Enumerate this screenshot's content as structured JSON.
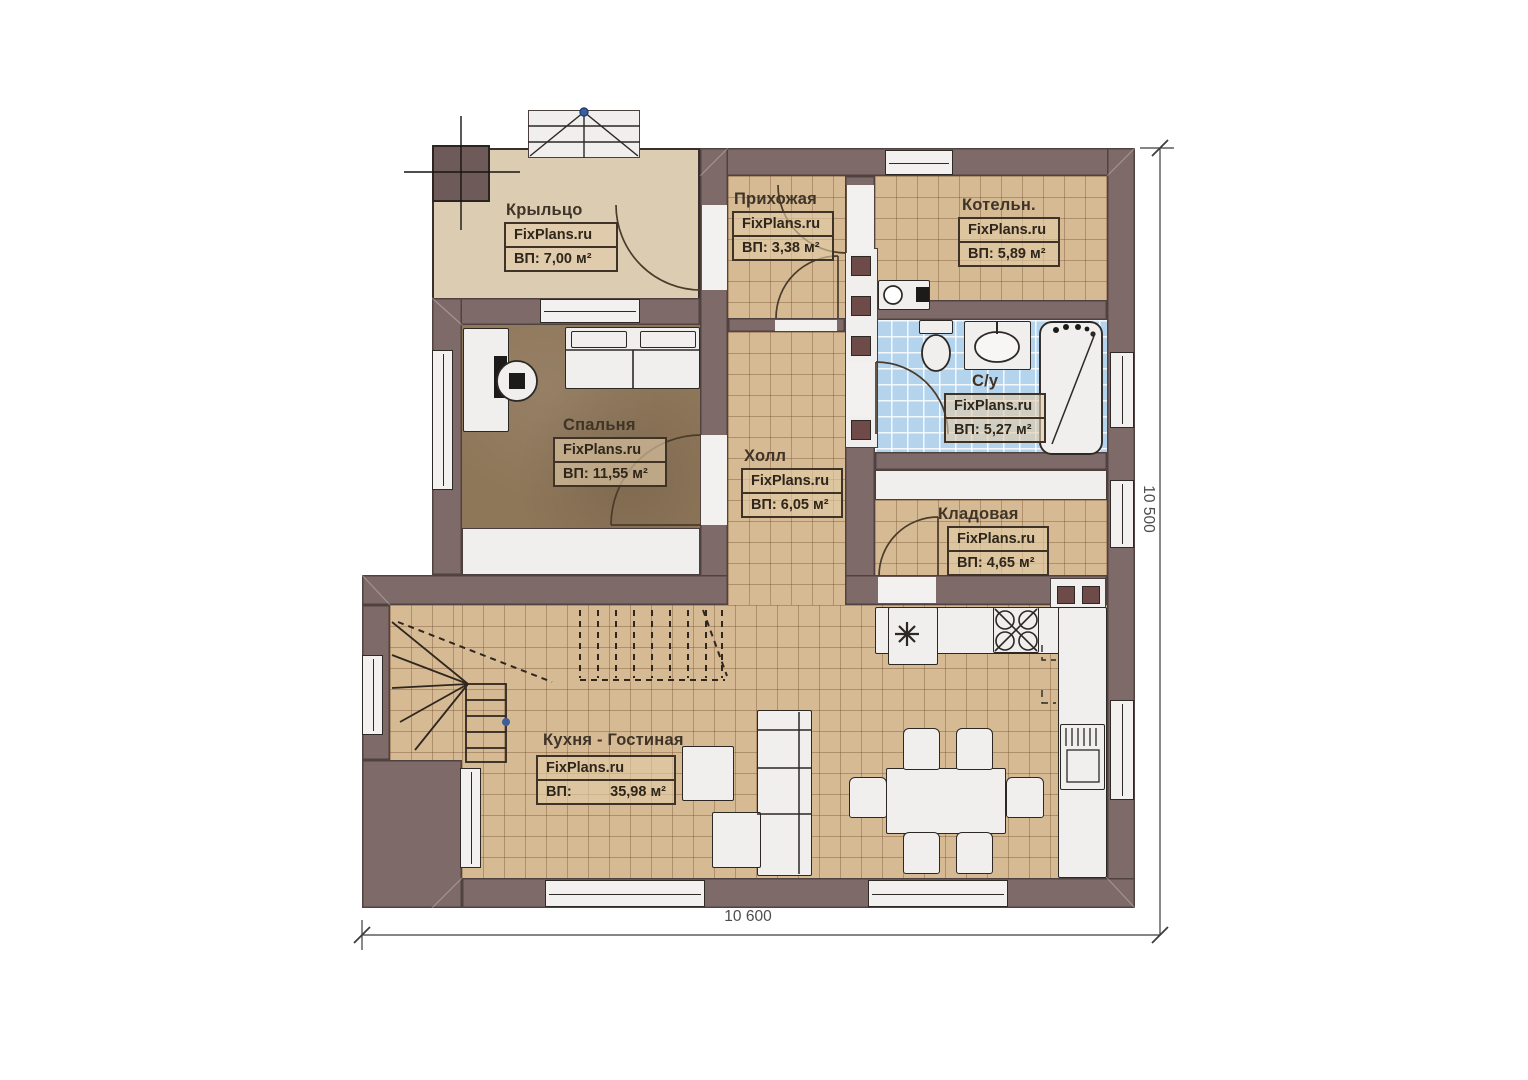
{
  "watermark_brand": "FixPlans.ru",
  "rooms": {
    "porch": {
      "name": "Крыльцо",
      "brand": "FixPlans.ru",
      "area": "ВП: 7,00 м²"
    },
    "entry": {
      "name": "Прихожая",
      "brand": "FixPlans.ru",
      "area": "ВП: 3,38 м²"
    },
    "boiler": {
      "name": "Котельн.",
      "brand": "FixPlans.ru",
      "area": "ВП: 5,89 м²"
    },
    "bedroom": {
      "name": "Спальня",
      "brand": "FixPlans.ru",
      "area": "ВП: 11,55 м²"
    },
    "hall": {
      "name": "Холл",
      "brand": "FixPlans.ru",
      "area": "ВП: 6,05 м²"
    },
    "bathroom": {
      "name": "С/у",
      "brand": "FixPlans.ru",
      "area": "ВП: 5,27 м²"
    },
    "storage": {
      "name": "Кладовая",
      "brand": "FixPlans.ru",
      "area": "ВП: 4,65 м²"
    },
    "kitchen": {
      "name": "Кухня - Гостиная",
      "brand": "FixPlans.ru",
      "area_prefix": "ВП:",
      "area_value": "35,98 м²"
    }
  },
  "dimensions": {
    "bottom": "10 600",
    "right": "10 500"
  },
  "colors": {
    "wall": "#7e6a68",
    "tile_floor": "#d6ba93",
    "carpet": "#8e7659",
    "bath_tile": "#b4d3ec",
    "porch_floor": "#dccdb2",
    "chimney": "#6e4a48",
    "fixture_white": "#f0efed",
    "accent_dot": "#3d5e9e"
  }
}
